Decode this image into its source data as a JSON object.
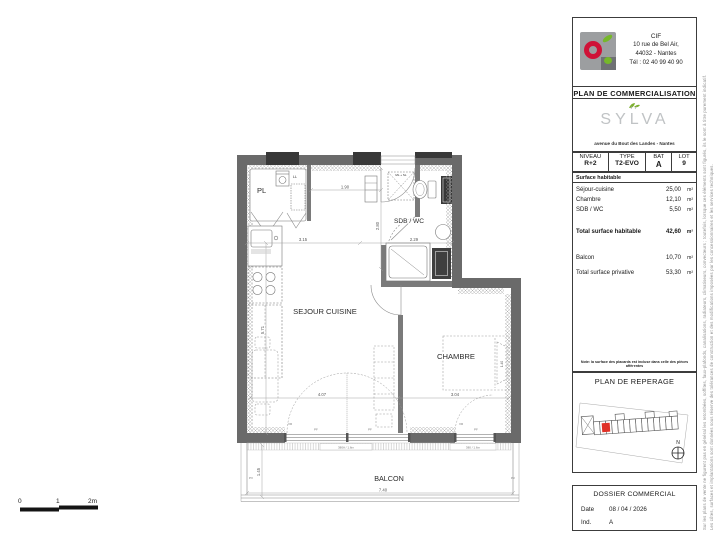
{
  "header": {
    "company": "CIF",
    "address1": "10 rue de Bel Air,",
    "address2": "44032 - Nantes",
    "address3": "Tél : 02 40 99 40 90",
    "doc_title": "PLAN DE COMMERCIALISATION",
    "brand": "SYLVA",
    "brand_sub": "avenue du Bout des Landes - Nantes"
  },
  "unit_table": {
    "niveau_label": "NIVEAU",
    "niveau_value": "R+2",
    "type_label": "TYPE",
    "type_value": "T2-EVO",
    "bat_label": "BAT",
    "bat_value": "A",
    "lot_label": "LOT",
    "lot_value": "9"
  },
  "surfaces": {
    "section_title": "Surface habitable",
    "rows": [
      {
        "label": "Séjour-cuisine",
        "value": "25,00",
        "unit": "m²"
      },
      {
        "label": "Chambre",
        "value": "12,10",
        "unit": "m²"
      },
      {
        "label": "SDB / WC",
        "value": "5,50",
        "unit": "m²"
      },
      {
        "label": "Total surface habitable",
        "value": "42,60",
        "unit": "m²"
      },
      {
        "label": "Balcon",
        "value": "10,70",
        "unit": "m²"
      },
      {
        "label": "Total surface privative",
        "value": "53,30",
        "unit": "m²"
      }
    ],
    "note": "Note: la surface des placards est incluse dans celle des pièces afférentes"
  },
  "reperage": {
    "title": "PLAN DE REPERAGE",
    "compass": "N"
  },
  "dossier": {
    "title": "DOSSIER COMMERCIAL",
    "date_label": "Date",
    "date_value": "08 / 04 / 2026",
    "ind_label": "Ind.",
    "ind_value": "A"
  },
  "disclaimer": {
    "col1": "Sur les plans de vente ne figurent pas en général les retombées, soffites, faux-plafonds, canalisations, radiateurs, climatiseurs, convecteurs ; toutefois, lorsque ces éléments sont figurés, ils le sont à titre purement indicatif.",
    "col2": "Les côtes, surfaces et implantations sont données sous réserve des tolérances de construction et des modifications imposées par les concessionnaires et les services techniques."
  },
  "plan": {
    "rooms": {
      "pl": "PL",
      "sdb_wc": "SDB / WC",
      "sejour": "SEJOUR CUISINE",
      "chambre": "CHAMBRE",
      "balcon": "BALCON"
    },
    "labels": {
      "ll": "LL",
      "ml_sl": "ML + SL",
      "vr": "VR",
      "pf": "PF",
      "pv": "PV",
      "window_sejour": "380A / 1.6m",
      "window_chambre": "380 / 1.6m"
    },
    "dims": {
      "entree": "1.90",
      "cuisine": "3.15",
      "sdb_l": "2.29",
      "sdb_h": "2.80",
      "sejour_h": "5.71",
      "sejour_l": "4.07",
      "chambre_l": "3.04",
      "balcon_l": "7.40",
      "balcon_p": "1.45",
      "lit": "1.40"
    },
    "scale_bar": {
      "t0": "0",
      "t1": "1",
      "t2": "2m"
    }
  },
  "colors": {
    "wall": "#6a6a6a",
    "pier": "#383838",
    "unit_red": "#e03127",
    "logo_red": "#cf1237",
    "logo_green": "#76b82a",
    "brand_gray": "#c0c3c5"
  }
}
